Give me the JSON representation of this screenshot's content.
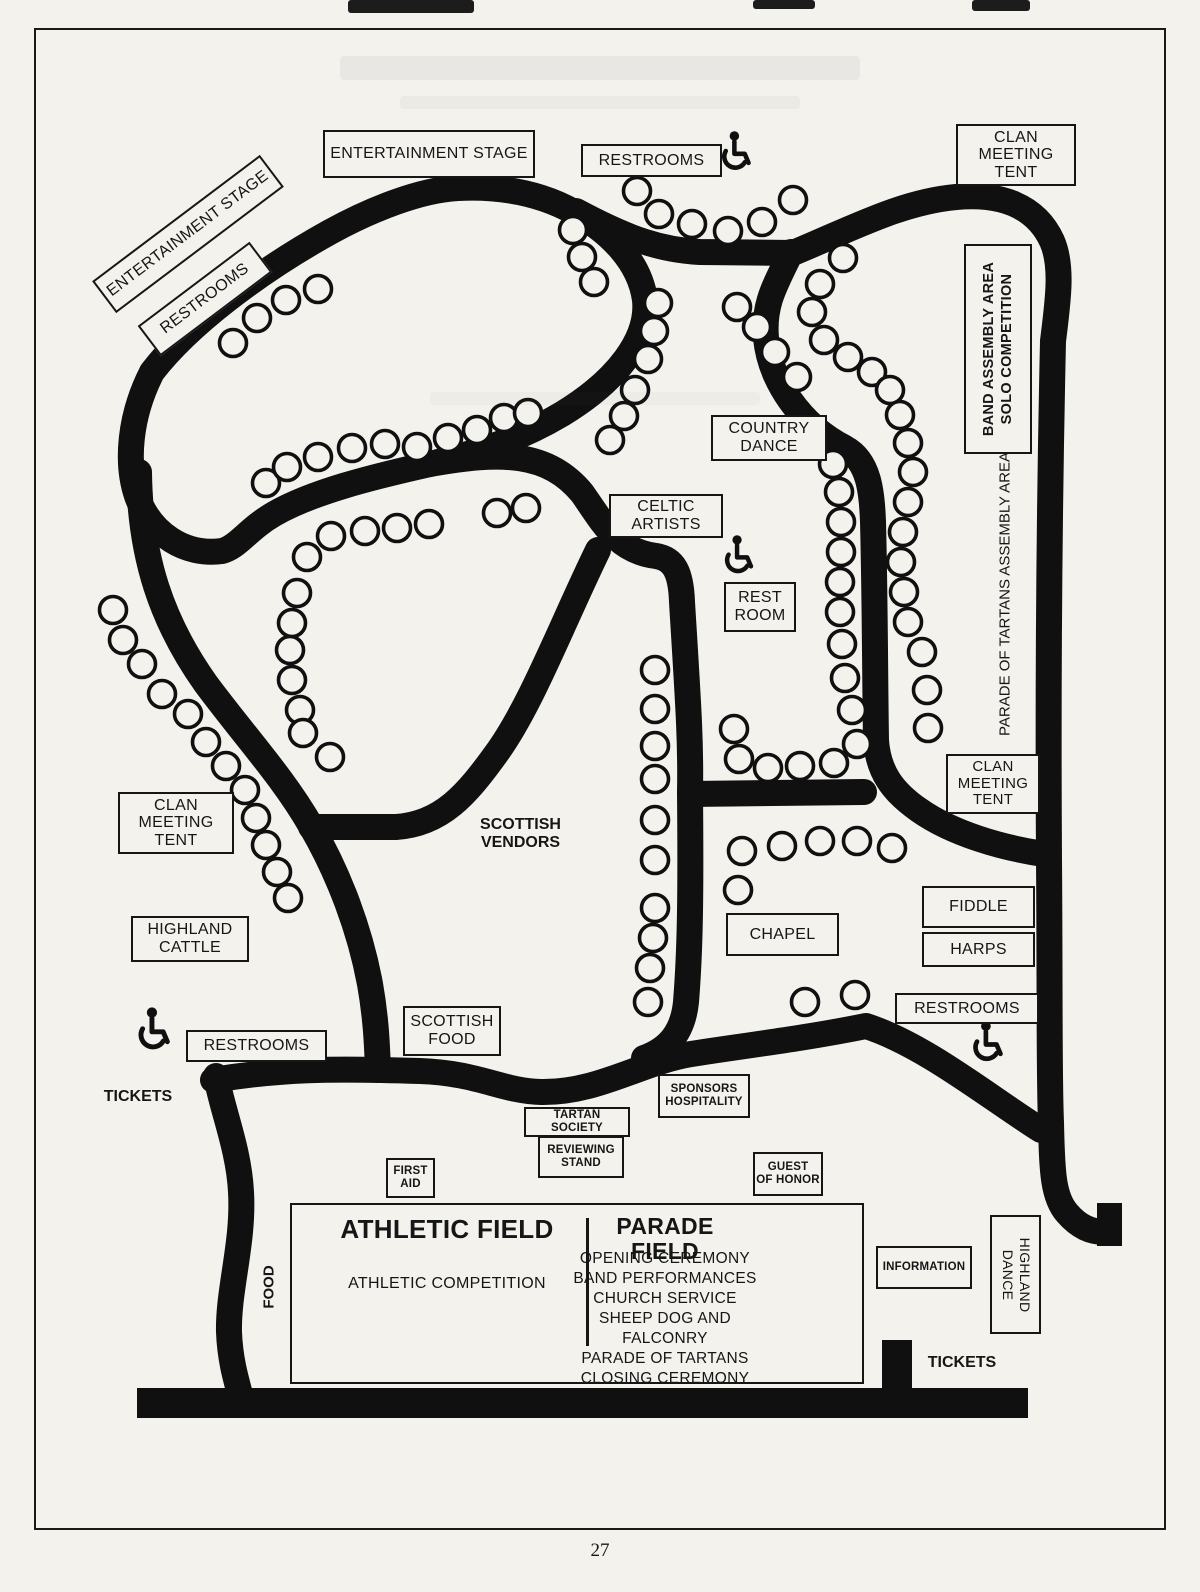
{
  "map": {
    "entertainment_stage": "ENTERTAINMENT STAGE",
    "entertainment_stage_rotated": "ENTERTAINMENT STAGE",
    "restrooms_rotated": "RESTROOMS",
    "restrooms_top": "RESTROOMS",
    "restrooms_left": "RESTROOMS",
    "restrooms_right": "RESTROOMS",
    "clan_meeting_tent": {
      "l1": "CLAN",
      "l2": "MEETING",
      "l3": "TENT"
    },
    "band_assembly": {
      "l1": "BAND ASSEMBLY AREA",
      "l2": "SOLO COMPETITION"
    },
    "parade_of_tartans_assembly": "PARADE OF TARTANS ASSEMBLY AREA",
    "country_dance": {
      "l1": "COUNTRY",
      "l2": "DANCE"
    },
    "celtic_artists": {
      "l1": "CELTIC",
      "l2": "ARTISTS"
    },
    "rest_room": {
      "l1": "REST",
      "l2": "ROOM"
    },
    "scottish_vendors": {
      "l1": "SCOTTISH",
      "l2": "VENDORS"
    },
    "highland_cattle": {
      "l1": "HIGHLAND",
      "l2": "CATTLE"
    },
    "scottish_food": {
      "l1": "SCOTTISH",
      "l2": "FOOD"
    },
    "chapel": "CHAPEL",
    "fiddle": "FIDDLE",
    "harps": "HARPS",
    "tickets_left": "TICKETS",
    "tickets_right": "TICKETS",
    "sponsors_hospitality": {
      "l1": "SPONSORS",
      "l2": "HOSPITALITY"
    },
    "tartan_society": "TARTAN SOCIETY",
    "reviewing_stand": {
      "l1": "REVIEWING",
      "l2": "STAND"
    },
    "first_aid": {
      "l1": "FIRST",
      "l2": "AID"
    },
    "guest_of_honor": {
      "l1": "GUEST",
      "l2": "OF HONOR"
    },
    "food": "FOOD",
    "information": "INFORMATION",
    "highland_dance": {
      "l1": "HIGHLAND",
      "l2": "DANCE"
    },
    "athletic_field": {
      "title": "ATHLETIC FIELD",
      "note": "ATHLETIC COMPETITION"
    },
    "parade_field": {
      "title": "PARADE FIELD",
      "events": [
        "OPENING CEREMONY",
        "BAND PERFORMANCES",
        "CHURCH SERVICE",
        "SHEEP DOG AND FALCONRY",
        "PARADE OF TARTANS",
        "CLOSING CEREMONY"
      ]
    },
    "page_number": "27",
    "icons": {
      "wheelchair_icon": "♿"
    },
    "colors": {
      "road": "#101010",
      "paper": "#f3f2ed"
    }
  }
}
